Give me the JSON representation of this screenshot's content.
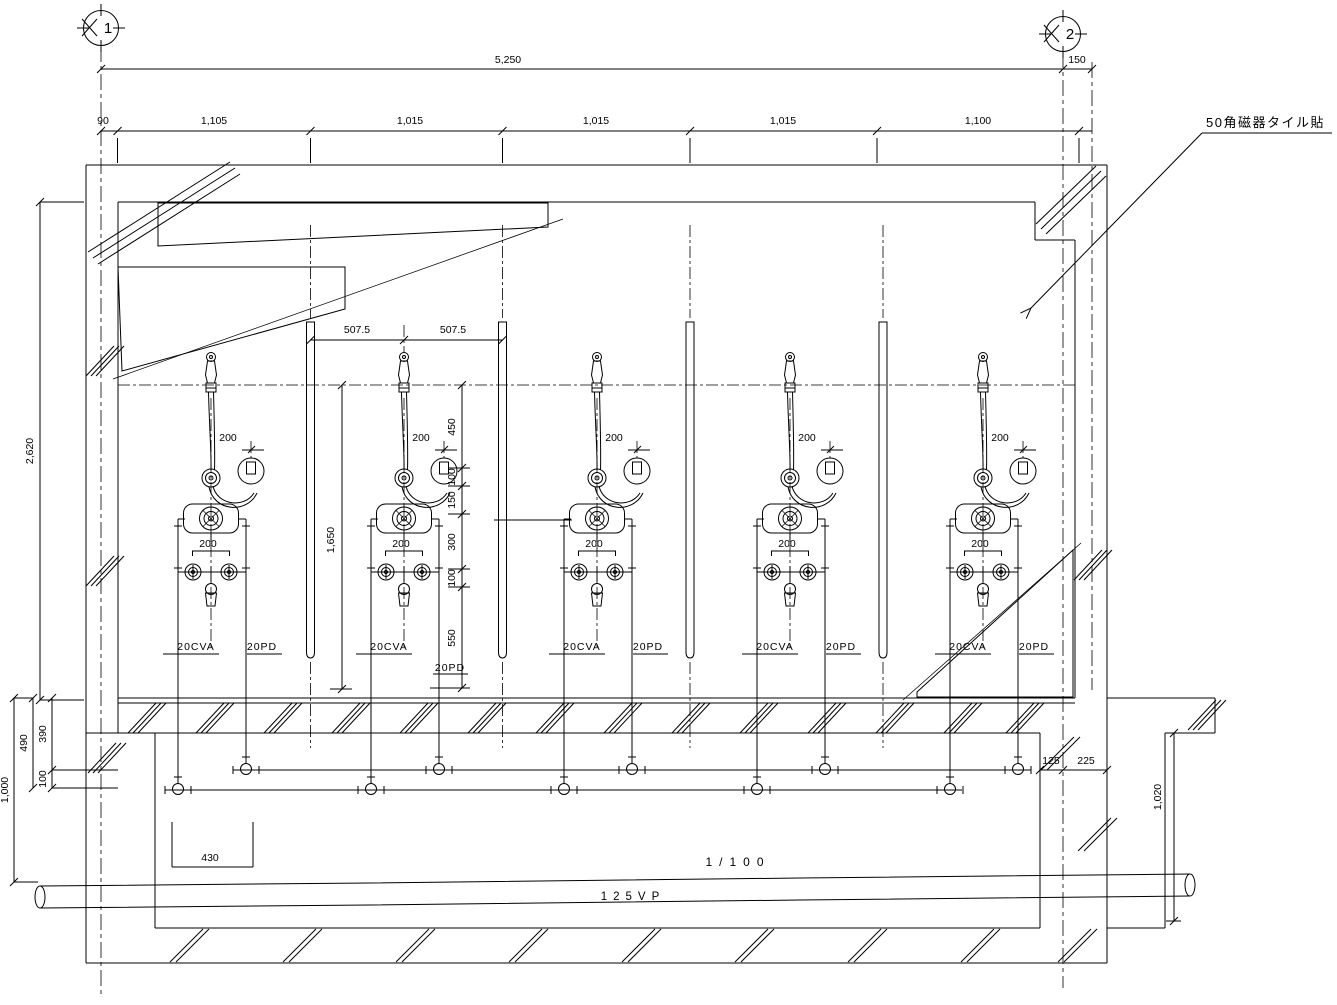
{
  "notes": {
    "tile": "50角磁器タイル貼"
  },
  "grid_bubbles": {
    "left": {
      "label": "1"
    },
    "right": {
      "label": "2"
    }
  },
  "pipe_run": {
    "slope": "1/100",
    "label": "125VP"
  },
  "dims": {
    "overall_width": "5,250",
    "right_offset": "150",
    "segments": [
      "90",
      "1,105",
      "1,015",
      "1,015",
      "1,015",
      "1,100"
    ],
    "wall_height": "2,620",
    "bay_left": "507.5",
    "bay_right": "507.5",
    "riser": "1,650",
    "stack": [
      "450",
      "100",
      "150",
      "300",
      "100",
      "550"
    ],
    "left_depth": {
      "total": "490",
      "upper": "390",
      "lower": "100",
      "pit": "1,000"
    },
    "right_pit": {
      "a": "125",
      "b": "225",
      "depth": "1,020"
    },
    "pit_width": "430"
  },
  "fixtures": [
    {
      "hook_offset": "200",
      "valve_spacing": "200",
      "supply_label": "20CVA",
      "drain_label": "20PD"
    },
    {
      "hook_offset": "200",
      "valve_spacing": "200",
      "supply_label": "20CVA",
      "drain_label": "20PD"
    },
    {
      "hook_offset": "200",
      "valve_spacing": "200",
      "supply_label": "20CVA",
      "drain_label": "20PD"
    },
    {
      "hook_offset": "200",
      "valve_spacing": "200",
      "supply_label": "20CVA",
      "drain_label": "20PD"
    },
    {
      "hook_offset": "200",
      "valve_spacing": "200",
      "supply_label": "20CVA",
      "drain_label": "20PD"
    }
  ]
}
